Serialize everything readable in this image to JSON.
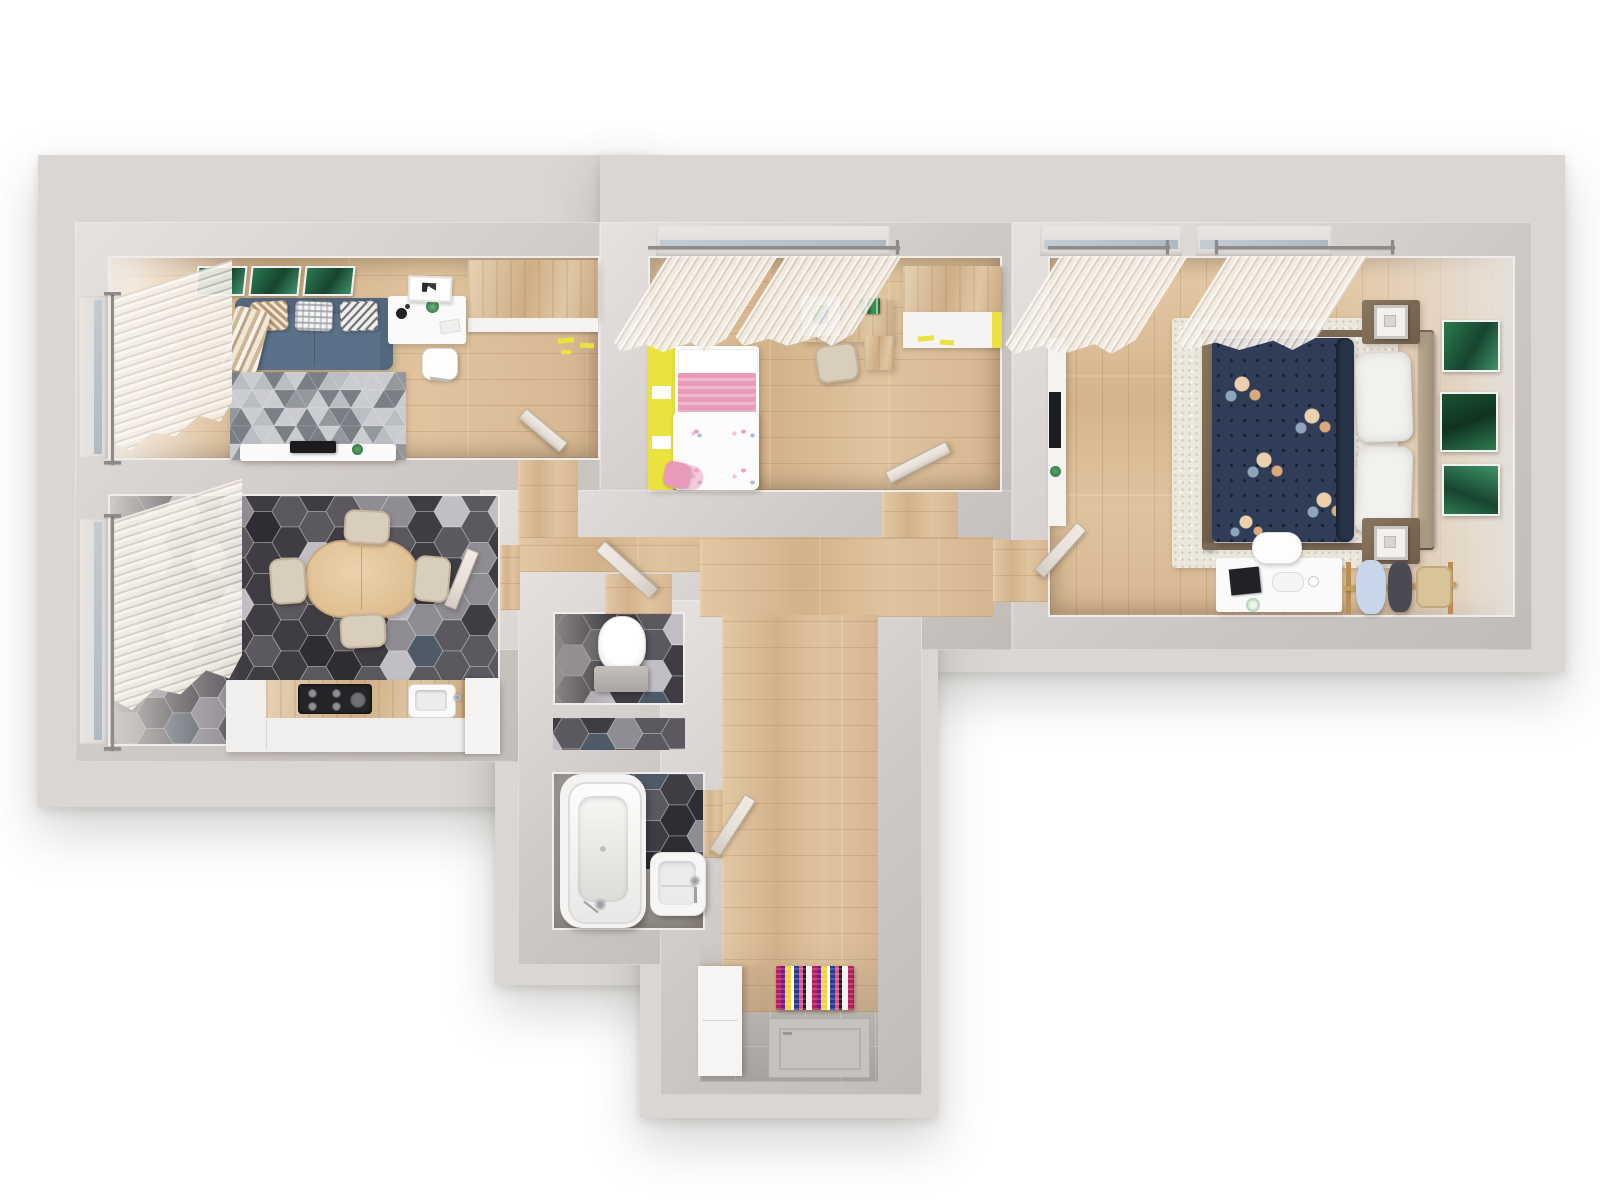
{
  "scene": {
    "label": "3D rendered apartment floor plan, top-down view",
    "background": "#ffffff"
  },
  "palette": {
    "slab": "#d9d6d4",
    "wall": "#cfc9c6",
    "wallLight": "#e9e6e4",
    "wood": "#dcbf9b",
    "hallWood": "#d8bb97",
    "creamRug": "#ece7dd",
    "rugGray": "#aeb2b6",
    "sofa": "#5b7189",
    "sofaDark": "#51667d",
    "navy": "#2f3d58",
    "navyDeep": "#273349",
    "yellow": "#eae23f",
    "pink": "#e89ab8",
    "green": "#2e7b50",
    "chair": "#d9cdbb",
    "counter": "#f1efee",
    "doorPanel": "#e6e0d9",
    "doorEdge": "#b9b2aa",
    "chrome": "#9aa0a4",
    "tileEntry": "#cac6c3",
    "brownWood": "#7c6a55"
  },
  "patterns": {
    "hex": {
      "tileW": 36,
      "tileH": 31,
      "colors": [
        "#3f3d43",
        "#5b585f",
        "#8f8c94",
        "#c1bec6",
        "#4e5a66",
        "#2f2d33"
      ],
      "weights": [
        0.34,
        0.22,
        0.16,
        0.12,
        0.08,
        0.08
      ],
      "stroke": "rgba(255,255,255,0.28)"
    },
    "triangles": {
      "w": 22,
      "h": 18,
      "base": "#aeb2b6",
      "colors": [
        "#7a7f85",
        "#caccd0",
        "#94989d",
        "#babec2"
      ],
      "weights": [
        0.35,
        0.35,
        0.15,
        0.15
      ]
    },
    "entryRugStripes": [
      "#b71c5c",
      "#6a1b9a",
      "#f3d23e",
      "#ffffff",
      "#283a8f",
      "#e04f88",
      "#1d1d1f",
      "#f0f0ec"
    ]
  },
  "rooms": [
    {
      "id": "living-room",
      "label": "Living room",
      "items": [
        "blue sofa with three patterned pillows",
        "striped throw blanket",
        "gray triangle-pattern rug",
        "TV console with TV and plant",
        "white desk with lamp, plant and chair",
        "leaning picture frame",
        "wardrobe with yellow accents",
        "three green wall prints",
        "window with sheer curtain"
      ]
    },
    {
      "id": "kids-bedroom",
      "label": "Kids bedroom",
      "items": [
        "single bed with yellow frame, pink blanket and floral duvet",
        "pink pillow",
        "wooden desk with chair and side unit",
        "wardrobe with yellow accents",
        "window with two sheer curtains"
      ]
    },
    {
      "id": "master-bedroom",
      "label": "Master bedroom",
      "items": [
        "double bed with navy floral duvet and white pillows",
        "two nightstands with lamps",
        "cream speckled rug",
        "three green wall prints",
        "white vanity desk with chair and accessories",
        "wooden clothes rack with garments",
        "narrow TV unit with TV and plant",
        "two windows with sheer curtains"
      ]
    },
    {
      "id": "kitchen",
      "label": "Kitchen / dining room",
      "items": [
        "dark hexagonal tile floor",
        "oval wooden dining table",
        "four beige chairs",
        "kitchen counter with cooktop and sink",
        "tall white cabinet",
        "window with sheer curtain"
      ]
    },
    {
      "id": "wc",
      "label": "WC",
      "items": [
        "toilet",
        "dark hexagonal tile floor"
      ]
    },
    {
      "id": "bathroom",
      "label": "Bathroom",
      "items": [
        "bathtub with faucet",
        "washbasin with faucet",
        "dark hexagonal tile floor"
      ]
    },
    {
      "id": "hallway",
      "label": "Hallway",
      "items": [
        "wooden plank floor",
        "open interior doors"
      ]
    },
    {
      "id": "entry",
      "label": "Entry hall",
      "items": [
        "colorful striped runner rug",
        "entrance door",
        "white cabinet",
        "tiled floor"
      ]
    }
  ]
}
